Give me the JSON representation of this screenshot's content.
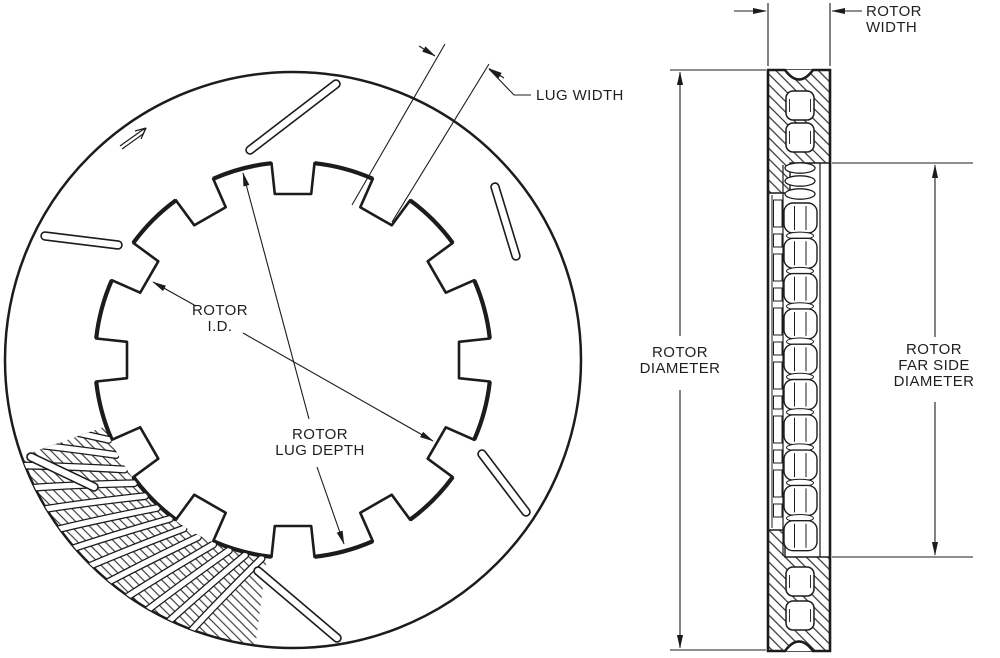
{
  "labels": {
    "rotor_id": [
      "ROTOR",
      "I.D."
    ],
    "rotor_lug_depth": [
      "ROTOR",
      "LUG DEPTH"
    ],
    "lug_width": [
      "LUG WIDTH"
    ],
    "rotor_width": [
      "ROTOR",
      "WIDTH"
    ],
    "rotor_diameter": [
      "ROTOR",
      "DIAMETER"
    ],
    "rotor_far_side_diameter": [
      "ROTOR",
      "FAR SIDE",
      "DIAMETER"
    ]
  },
  "colors": {
    "line": "#1c1c1c",
    "background": "#ffffff"
  }
}
